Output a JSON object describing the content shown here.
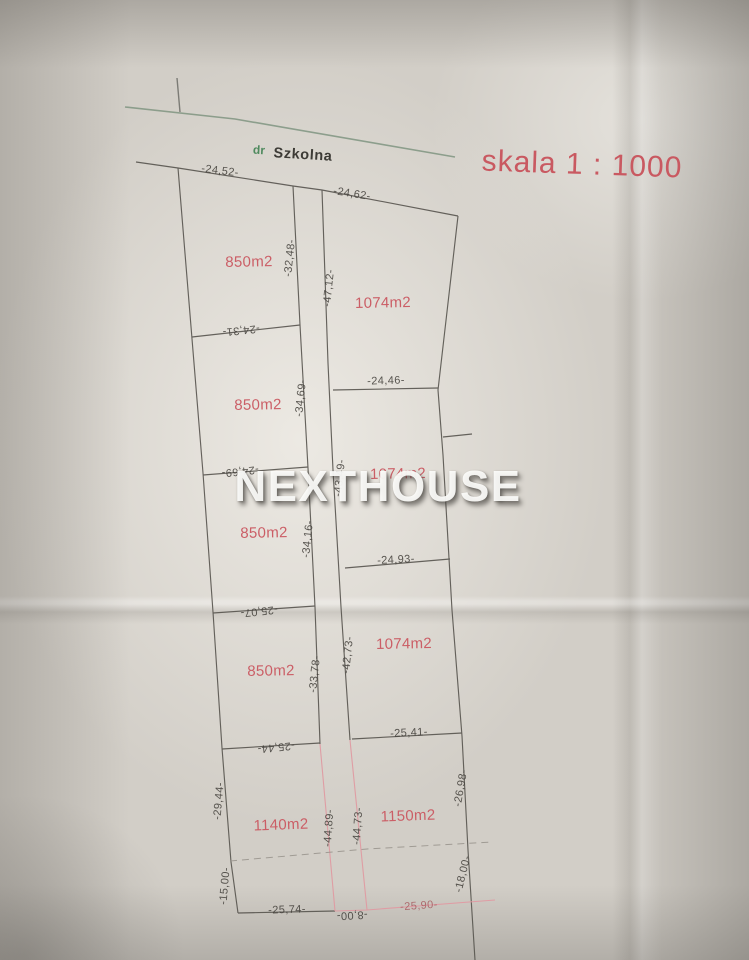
{
  "scale_label": "skala  1 : 1000",
  "watermark": "NEXTHOUSE",
  "street": {
    "prefix": "dr",
    "name": "Szkolna"
  },
  "frontage": {
    "left": "-24,52-",
    "right": "-24,62-"
  },
  "parcels": {
    "left_column": [
      {
        "area": "850m2",
        "side": "-32,48-",
        "bottom": "-24,31-"
      },
      {
        "area": "850m2",
        "side": "-34,69-",
        "bottom": "-24,69-"
      },
      {
        "area": "850m2",
        "side": "-34,16-",
        "bottom": "-25,07-"
      },
      {
        "area": "850m2",
        "side": "-33,78-",
        "bottom": "-25,44-"
      }
    ],
    "right_column": [
      {
        "area": "1074m2",
        "side": "-47,12-",
        "bottom": "-24,46-"
      },
      {
        "area": "1074m2",
        "side": "-43,49-",
        "bottom": "-24,93-"
      },
      {
        "area": "1074m2",
        "side": "-42,73-",
        "bottom": "-25,41-"
      }
    ],
    "bottom_left": {
      "area": "1140m2",
      "left_upper": "-29,44-",
      "left_lower": "-15,00-",
      "side": "-44,89-",
      "bottom": "-25,74-"
    },
    "bottom_right": {
      "area": "1150m2",
      "side": "-44,73-",
      "right_upper": "-26,98-",
      "right_lower": "-18,00-",
      "bottom": "-25,90-"
    },
    "road_bottom_width": "-8,00-"
  },
  "colors": {
    "red_text": "#cb5e66",
    "green_line": "#7f9480",
    "pink_line": "#e09aa2",
    "black_line": "#57544e"
  }
}
